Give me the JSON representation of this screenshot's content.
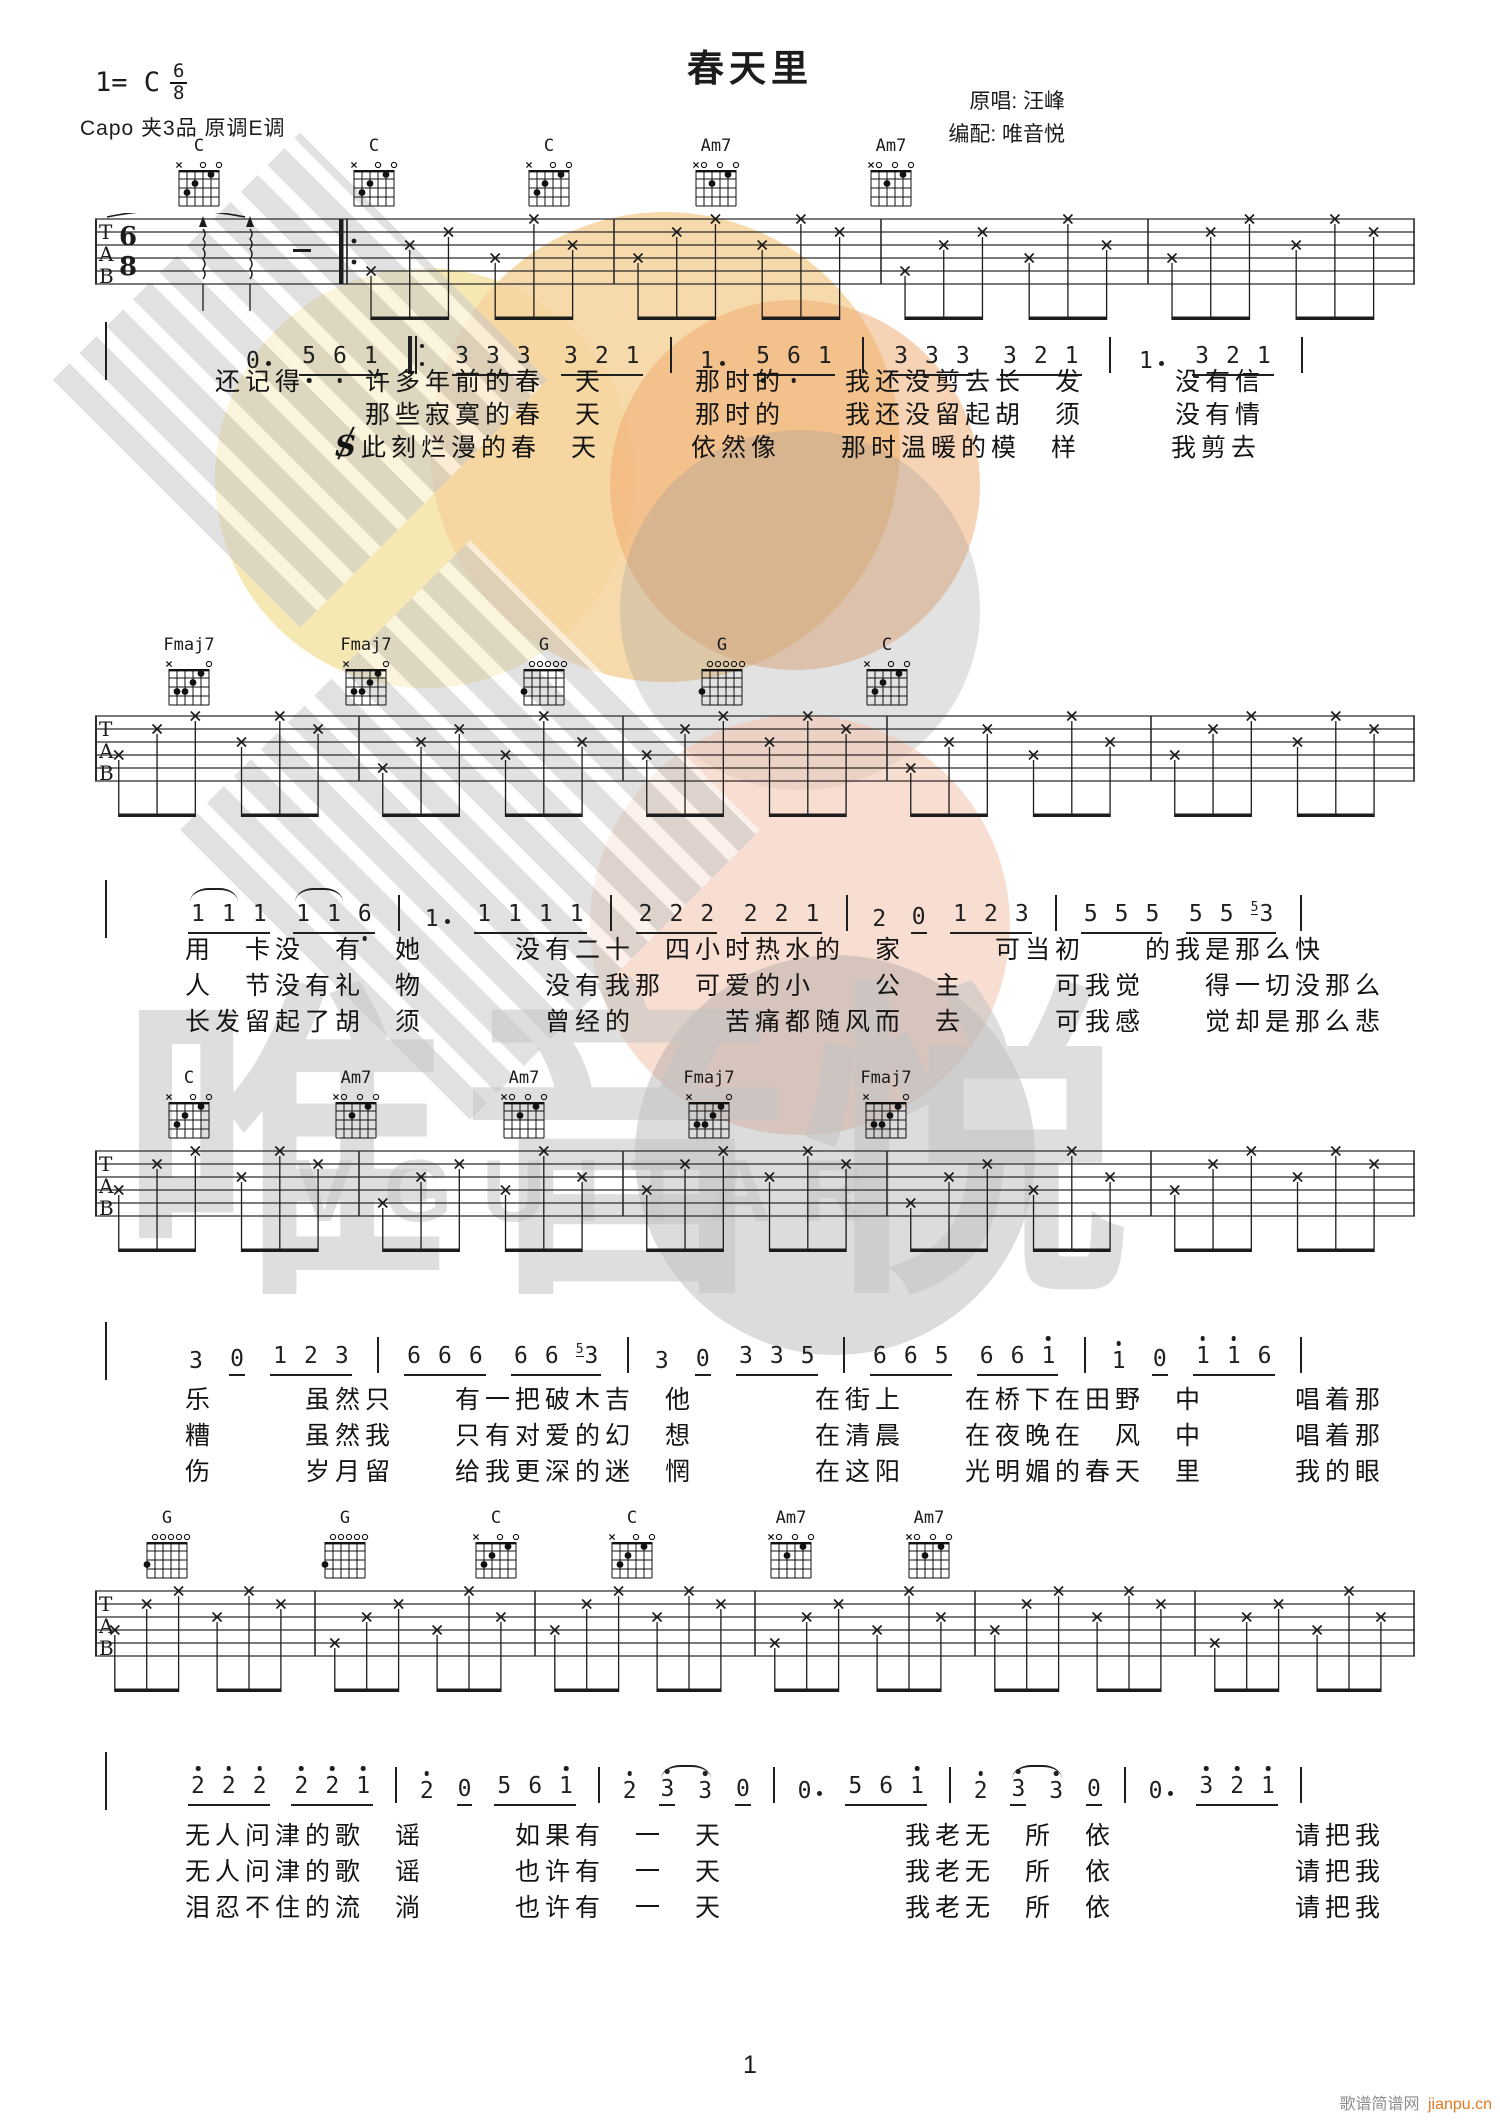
{
  "header": {
    "title": "春天里",
    "key_label": "1= C",
    "time_top": "6",
    "time_bottom": "8",
    "capo_line": "Capo 夹3品 原调E调",
    "credit_original": "原唱: 汪峰",
    "credit_arranger": "编配: 唯音悦"
  },
  "symbols": {
    "segno": "S"
  },
  "tab_clef": [
    "T",
    "A",
    "B"
  ],
  "watermark": {
    "brand": "唯音悦",
    "brand_latin": "VGUITAR"
  },
  "footer": {
    "page_number": "1",
    "site_name": "歌谱简谱网",
    "site_url": "jianpu.cn",
    "site_url_color": "#e4791f"
  },
  "chord_shapes": {
    "C": {
      "top": [
        "x",
        "",
        "",
        "o",
        "",
        "o"
      ],
      "dots": [
        [
          5,
          3
        ],
        [
          4,
          2
        ],
        [
          2,
          1
        ]
      ]
    },
    "Am7": {
      "top": [
        "x",
        "o",
        "",
        "o",
        "",
        "o"
      ],
      "dots": [
        [
          4,
          2
        ],
        [
          2,
          1
        ]
      ]
    },
    "Fmaj7": {
      "top": [
        "x",
        "",
        "",
        "",
        "",
        "o"
      ],
      "dots": [
        [
          5,
          3
        ],
        [
          4,
          3
        ],
        [
          3,
          2
        ],
        [
          2,
          1
        ]
      ]
    },
    "G": {
      "top": [
        "",
        "o",
        "o",
        "o",
        "o",
        "o"
      ],
      "dots": [
        [
          6,
          3
        ]
      ]
    }
  },
  "systems": [
    {
      "chords": [
        {
          "name": "C",
          "x": 195
        },
        {
          "name": "C",
          "x": 370
        },
        {
          "name": "C",
          "x": 545
        },
        {
          "name": "Am7",
          "x": 712
        },
        {
          "name": "Am7",
          "x": 887
        }
      ],
      "jianpu": [
        {
          "n": "0",
          "dot": 1
        },
        {
          "g": [
            {
              "n": "5",
              "lo": 1
            },
            {
              "n": "6",
              "lo": 1
            },
            {
              "n": "1"
            }
          ]
        },
        {
          "rep": 1
        },
        {
          "g": [
            {
              "n": "3"
            },
            {
              "n": "3"
            },
            {
              "n": "3"
            }
          ]
        },
        {
          "g": [
            {
              "n": "3"
            },
            {
              "n": "2"
            },
            {
              "n": "1"
            }
          ]
        },
        {
          "bar": 1
        },
        {
          "n": "1",
          "dot": 1
        },
        {
          "g": [
            {
              "n": "5",
              "lo": 1
            },
            {
              "n": "6",
              "lo": 1
            },
            {
              "n": "1"
            }
          ]
        },
        {
          "bar": 1
        },
        {
          "g": [
            {
              "n": "3"
            },
            {
              "n": "3"
            },
            {
              "n": "3"
            }
          ]
        },
        {
          "g": [
            {
              "n": "3"
            },
            {
              "n": "2"
            },
            {
              "n": "1"
            }
          ]
        },
        {
          "bar": 1
        },
        {
          "n": "1",
          "dot": 1
        },
        {
          "g": [
            {
              "n": "3"
            },
            {
              "n": "2"
            },
            {
              "n": "1"
            }
          ]
        },
        {
          "bar": 1
        }
      ],
      "lyrics": [
        {
          "text": "　还记得　　许多年前的春　天　　　那时的　　我还没剪去长　发　　　没有信"
        },
        {
          "text": "　　　　　　那些寂寞的春　天　　　那时的　　我还没留起胡　须　　　没有情"
        },
        {
          "pre": "　　　　　",
          "segno": true,
          "text": "此刻烂漫的春　天　　　依然像　　那时温暖的模　样　　　我剪去"
        }
      ]
    },
    {
      "chords": [
        {
          "name": "Fmaj7",
          "x": 185
        },
        {
          "name": "Fmaj7",
          "x": 362
        },
        {
          "name": "G",
          "x": 540
        },
        {
          "name": "G",
          "x": 718
        },
        {
          "name": "C",
          "x": 883
        }
      ],
      "jianpu": [
        {
          "g": [
            {
              "n": "1"
            },
            {
              "n": "1"
            },
            {
              "n": "1"
            }
          ],
          "arc": 1
        },
        {
          "g": [
            {
              "n": "1"
            },
            {
              "n": "1"
            },
            {
              "n": "6",
              "lo": 1
            }
          ],
          "arc": 1
        },
        {
          "bar": 1
        },
        {
          "n": "1",
          "dot": 1
        },
        {
          "g": [
            {
              "n": "1"
            },
            {
              "n": "1"
            },
            {
              "n": "1"
            },
            {
              "n": "1"
            }
          ]
        },
        {
          "bar": 1
        },
        {
          "g": [
            {
              "n": "2"
            },
            {
              "n": "2"
            },
            {
              "n": "2"
            }
          ]
        },
        {
          "g": [
            {
              "n": "2"
            },
            {
              "n": "2"
            },
            {
              "n": "1"
            }
          ]
        },
        {
          "bar": 1
        },
        {
          "n": "2"
        },
        {
          "n": "0",
          "u": 1
        },
        {
          "g": [
            {
              "n": "1"
            },
            {
              "n": "2"
            },
            {
              "n": "3"
            }
          ]
        },
        {
          "bar": 1
        },
        {
          "g": [
            {
              "n": "5"
            },
            {
              "n": "5"
            },
            {
              "n": "5"
            }
          ]
        },
        {
          "g": [
            {
              "n": "5"
            },
            {
              "n": "5"
            },
            {
              "n": "3",
              "grace": "5"
            }
          ]
        },
        {
          "bar": 1
        }
      ],
      "lyrics": [
        {
          "text": "用　卡没　有　她　　　没有二十　四小时热水的　家　　　可当初　　的我是那么快"
        },
        {
          "text": "人　节没有礼　物　　　　没有我那　可爱的小　　公　主　　　可我觉　　得一切没那么"
        },
        {
          "text": "长发留起了胡　须　　　　曾经的　　　苦痛都随风而　去　　　可我感　　觉却是那么悲"
        }
      ]
    },
    {
      "chords": [
        {
          "name": "C",
          "x": 185
        },
        {
          "name": "Am7",
          "x": 352
        },
        {
          "name": "Am7",
          "x": 520
        },
        {
          "name": "Fmaj7",
          "x": 705
        },
        {
          "name": "Fmaj7",
          "x": 882
        }
      ],
      "jianpu": [
        {
          "n": "3"
        },
        {
          "n": "0",
          "u": 1
        },
        {
          "g": [
            {
              "n": "1"
            },
            {
              "n": "2"
            },
            {
              "n": "3"
            }
          ]
        },
        {
          "bar": 1
        },
        {
          "g": [
            {
              "n": "6"
            },
            {
              "n": "6"
            },
            {
              "n": "6"
            }
          ]
        },
        {
          "g": [
            {
              "n": "6"
            },
            {
              "n": "6"
            },
            {
              "n": "3",
              "grace": "5"
            }
          ]
        },
        {
          "bar": 1
        },
        {
          "n": "3"
        },
        {
          "n": "0",
          "u": 1
        },
        {
          "g": [
            {
              "n": "3"
            },
            {
              "n": "3"
            },
            {
              "n": "5"
            }
          ]
        },
        {
          "bar": 1
        },
        {
          "g": [
            {
              "n": "6"
            },
            {
              "n": "6"
            },
            {
              "n": "5"
            }
          ]
        },
        {
          "g": [
            {
              "n": "6"
            },
            {
              "n": "6"
            },
            {
              "n": "1",
              "hi": 1
            }
          ]
        },
        {
          "bar": 1
        },
        {
          "n": "1",
          "hi": 1
        },
        {
          "n": "0",
          "u": 1
        },
        {
          "g": [
            {
              "n": "1",
              "hi": 1
            },
            {
              "n": "1",
              "hi": 1
            },
            {
              "n": "6"
            }
          ]
        },
        {
          "bar": 1
        }
      ],
      "lyrics": [
        {
          "text": "乐　　　虽然只　　有一把破木吉　他　　　　在街上　　在桥下在田野　中　　　唱着那"
        },
        {
          "text": "糟　　　虽然我　　只有对爱的幻　想　　　　在清晨　　在夜晚在　风　中　　　唱着那"
        },
        {
          "text": "伤　　　岁月留　　给我更深的迷　惘　　　　在这阳　　光明媚的春天　里　　　我的眼"
        }
      ]
    },
    {
      "chords": [
        {
          "name": "G",
          "x": 163
        },
        {
          "name": "G",
          "x": 341
        },
        {
          "name": "C",
          "x": 492
        },
        {
          "name": "C",
          "x": 628
        },
        {
          "name": "Am7",
          "x": 787
        },
        {
          "name": "Am7",
          "x": 925
        }
      ],
      "jianpu": [
        {
          "g": [
            {
              "n": "2",
              "hi": 1
            },
            {
              "n": "2",
              "hi": 1
            },
            {
              "n": "2",
              "hi": 1
            }
          ]
        },
        {
          "g": [
            {
              "n": "2",
              "hi": 1
            },
            {
              "n": "2",
              "hi": 1
            },
            {
              "n": "1",
              "hi": 1
            }
          ]
        },
        {
          "bar": 1
        },
        {
          "n": "2",
          "hi": 1
        },
        {
          "n": "0",
          "u": 1
        },
        {
          "g": [
            {
              "n": "5"
            },
            {
              "n": "6"
            },
            {
              "n": "1",
              "hi": 1
            }
          ]
        },
        {
          "bar": 1
        },
        {
          "n": "2",
          "hi": 1
        },
        {
          "n": "3",
          "hi": 1,
          "u": 1
        },
        {
          "n": "3",
          "hi": 1,
          "arc2": 1
        },
        {
          "n": "0",
          "u": 1
        },
        {
          "bar": 1
        },
        {
          "n": "0",
          "dot": 1
        },
        {
          "g": [
            {
              "n": "5"
            },
            {
              "n": "6"
            },
            {
              "n": "1",
              "hi": 1
            }
          ]
        },
        {
          "bar": 1
        },
        {
          "n": "2",
          "hi": 1
        },
        {
          "n": "3",
          "hi": 1,
          "u": 1
        },
        {
          "n": "3",
          "hi": 1,
          "arc2": 1
        },
        {
          "n": "0",
          "u": 1
        },
        {
          "bar": 1
        },
        {
          "n": "0",
          "dot": 1
        },
        {
          "g": [
            {
              "n": "3",
              "hi": 1
            },
            {
              "n": "2",
              "hi": 1
            },
            {
              "n": "1",
              "hi": 1
            }
          ]
        },
        {
          "bar": 1
        }
      ],
      "lyrics": [
        {
          "text": "无人问津的歌　谣　　　如果有　一　天　　　　　　我老无　所　依　　　　　　请把我"
        },
        {
          "text": "无人问津的歌　谣　　　也许有　一　天　　　　　　我老无　所　依　　　　　　请把我"
        },
        {
          "text": "泪忍不住的流　淌　　　也许有　一　天　　　　　　我老无　所　依　　　　　　请把我"
        }
      ]
    }
  ]
}
